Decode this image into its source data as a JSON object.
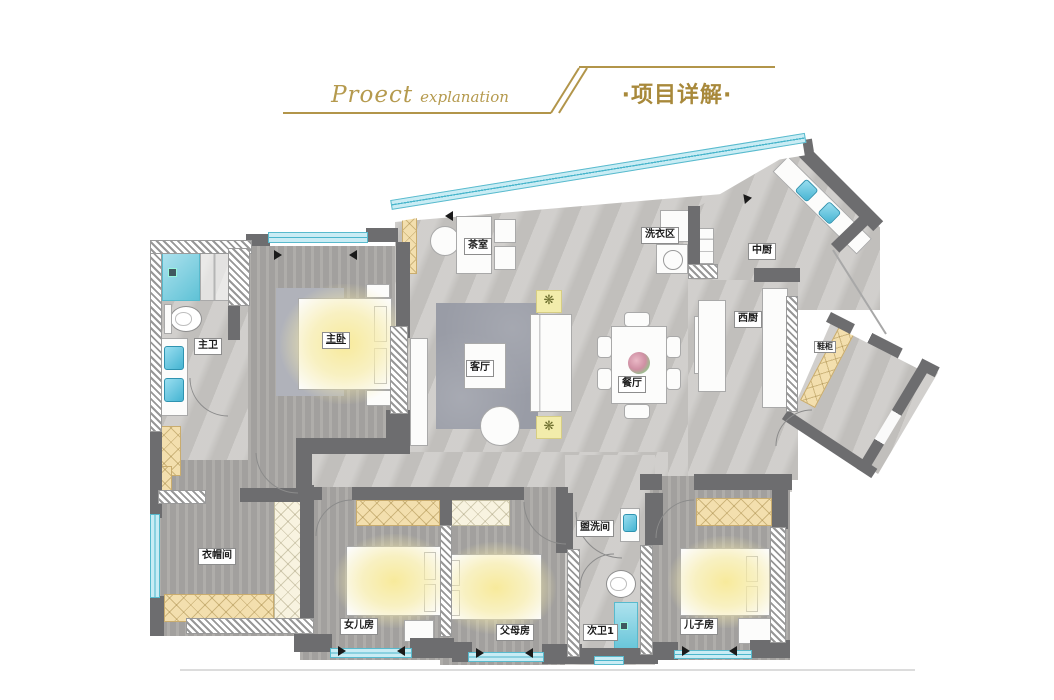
{
  "header": {
    "title_en_main": "Proect",
    "title_en_sub": "explanation",
    "title_cn": "·项目详解·"
  },
  "floorplan": {
    "rooms": [
      {
        "id": "tea-room",
        "label": "茶室"
      },
      {
        "id": "laundry-area",
        "label": "洗衣区"
      },
      {
        "id": "chinese-kitchen",
        "label": "中厨"
      },
      {
        "id": "western-kitchen",
        "label": "西厨"
      },
      {
        "id": "shoe-cabinet",
        "label": "鞋柜"
      },
      {
        "id": "master-bath",
        "label": "主卫"
      },
      {
        "id": "master-bedroom",
        "label": "主卧"
      },
      {
        "id": "living-room",
        "label": "客厅"
      },
      {
        "id": "dining-room",
        "label": "餐厅"
      },
      {
        "id": "cloakroom",
        "label": "衣帽间"
      },
      {
        "id": "daughter-room",
        "label": "女儿房"
      },
      {
        "id": "parents-room",
        "label": "父母房"
      },
      {
        "id": "washroom",
        "label": "盥洗间"
      },
      {
        "id": "second-bath",
        "label": "次卫1"
      },
      {
        "id": "son-room",
        "label": "儿子房"
      }
    ],
    "icons": {
      "ceiling_light": "❋"
    },
    "colors": {
      "gold": "#b2954a",
      "gold_dark": "#a8893b",
      "wall": "#6d6d6f",
      "window_glass": "#c9ecf4",
      "window_line": "#4ab6cc",
      "floor_light": "#c8c6c3",
      "floor_dark": "#a8a6a3",
      "bed_glow": "#f6edae",
      "cabinet_tan": "#f3dfae",
      "rug": "#999ca6"
    }
  }
}
